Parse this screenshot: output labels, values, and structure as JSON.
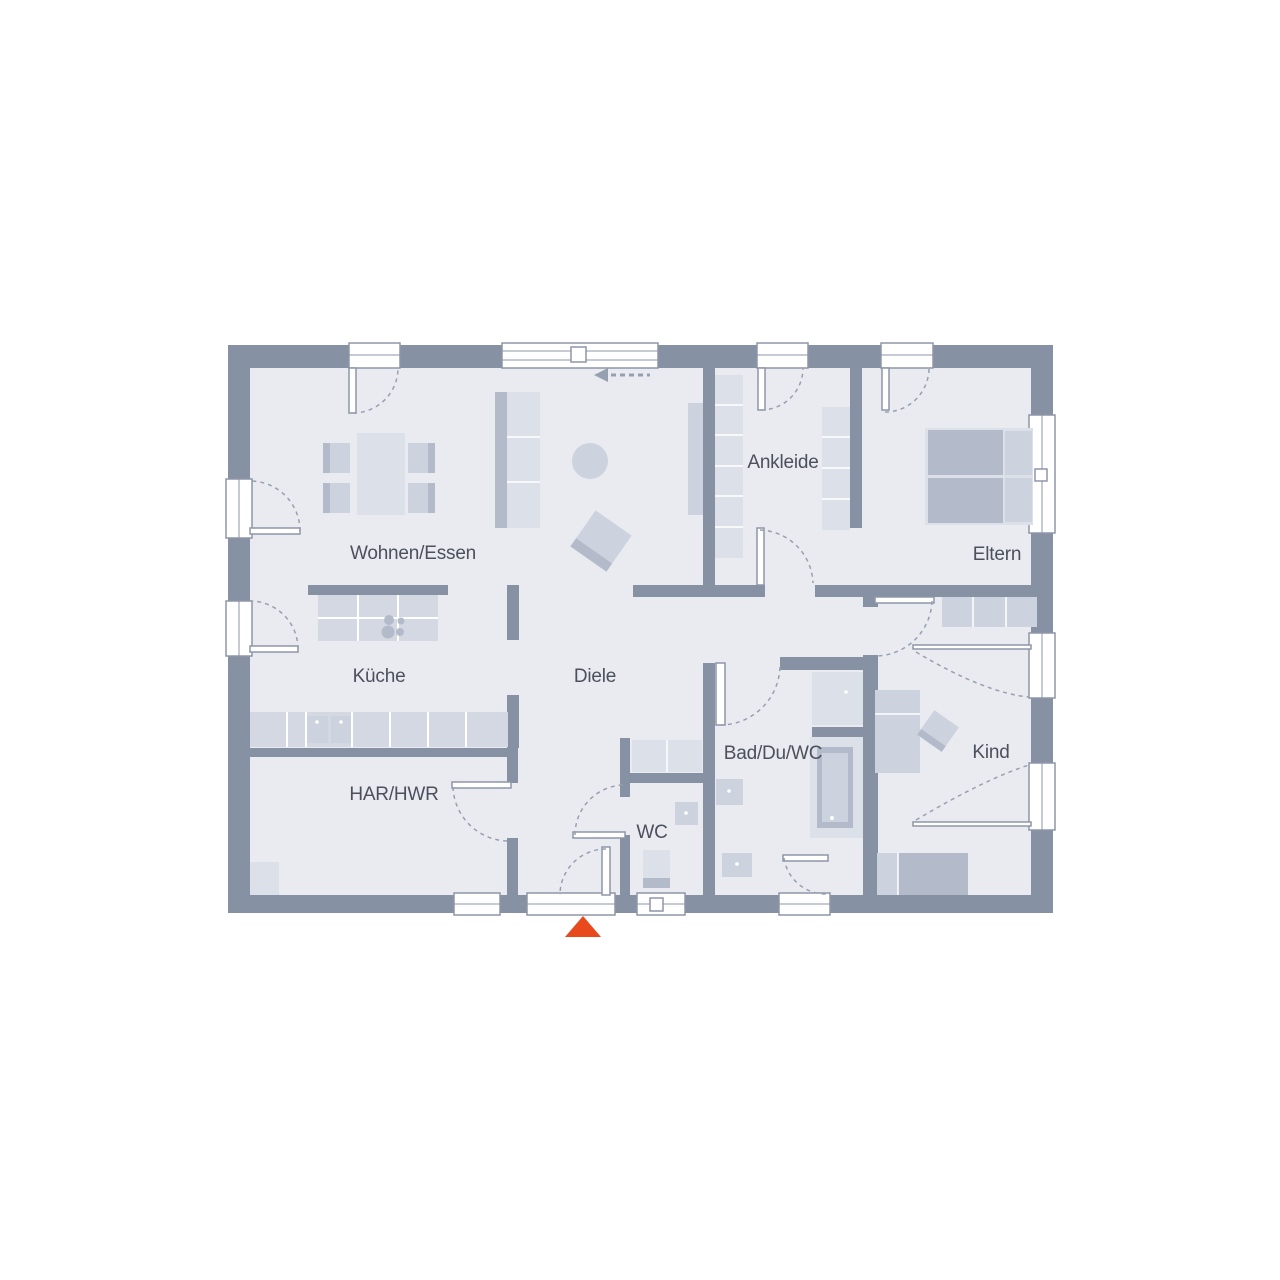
{
  "theme": {
    "bg": "#ffffff",
    "floor": "#e9ebf1",
    "wall": "#8691a3",
    "frame": "#8d96a8",
    "dash": "#97a0b1",
    "furn1": "#dce0e9",
    "furn2": "#ccd2de",
    "furn3": "#b3bbca",
    "counter": "#d3d8e2",
    "text": "#4b505c",
    "accent": "#e8491d"
  },
  "rooms": {
    "wohnen_essen": {
      "label": "Wohnen/Essen"
    },
    "kueche": {
      "label": "Küche"
    },
    "diele": {
      "label": "Diele"
    },
    "har_hwr": {
      "label": "HAR/HWR"
    },
    "wc": {
      "label": "WC"
    },
    "bad_du_wc": {
      "label": "Bad/Du/WC"
    },
    "ankleide": {
      "label": "Ankleide"
    },
    "eltern": {
      "label": "Eltern"
    },
    "kind": {
      "label": "Kind"
    }
  }
}
